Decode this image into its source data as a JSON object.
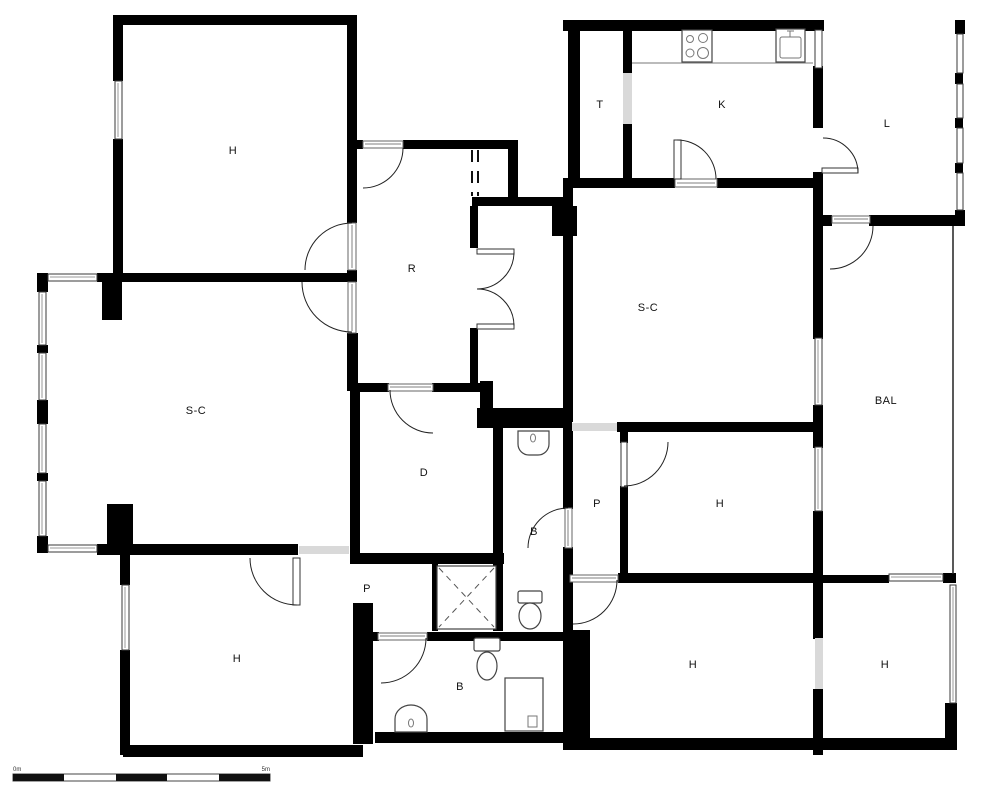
{
  "plan": {
    "type": "apartment-floor-plan",
    "rooms": [
      {
        "id": "bedroom-top-left",
        "label": "H"
      },
      {
        "id": "pantry-top",
        "label": "T"
      },
      {
        "id": "kitchen",
        "label": "K"
      },
      {
        "id": "laundry-top-right",
        "label": "L"
      },
      {
        "id": "hall-corridor",
        "label": "R"
      },
      {
        "id": "living-right",
        "label": "S-C"
      },
      {
        "id": "living-left",
        "label": "S-C"
      },
      {
        "id": "balcony",
        "label": "BAL"
      },
      {
        "id": "dressing",
        "label": "D"
      },
      {
        "id": "passage-right",
        "label": "P"
      },
      {
        "id": "bedroom-mid-right",
        "label": "H"
      },
      {
        "id": "bathroom-center",
        "label": "B"
      },
      {
        "id": "passage-left",
        "label": "P"
      },
      {
        "id": "bedroom-bottom-left",
        "label": "H"
      },
      {
        "id": "bathroom-bottom",
        "label": "B"
      },
      {
        "id": "bedroom-bottom-center",
        "label": "H"
      },
      {
        "id": "bedroom-bottom-right",
        "label": "H"
      }
    ],
    "fixtures": [
      {
        "name": "stove-icon",
        "location": "kitchen"
      },
      {
        "name": "kitchen-sink-icon",
        "location": "kitchen"
      },
      {
        "name": "washbasin-icon",
        "location": "bathroom-center"
      },
      {
        "name": "toilet-icon",
        "location": "bathroom-center"
      },
      {
        "name": "shower-icon",
        "location": "passage-left"
      },
      {
        "name": "toilet-icon",
        "location": "bathroom-bottom"
      },
      {
        "name": "washbasin-icon",
        "location": "bathroom-bottom"
      },
      {
        "name": "shower-tray-icon",
        "location": "bathroom-bottom"
      }
    ],
    "scale_bar": {
      "start": "0m",
      "end": "5m"
    },
    "colors": {
      "wall": "#000000",
      "opening": "#d9d9d9",
      "background": "#ffffff"
    }
  }
}
